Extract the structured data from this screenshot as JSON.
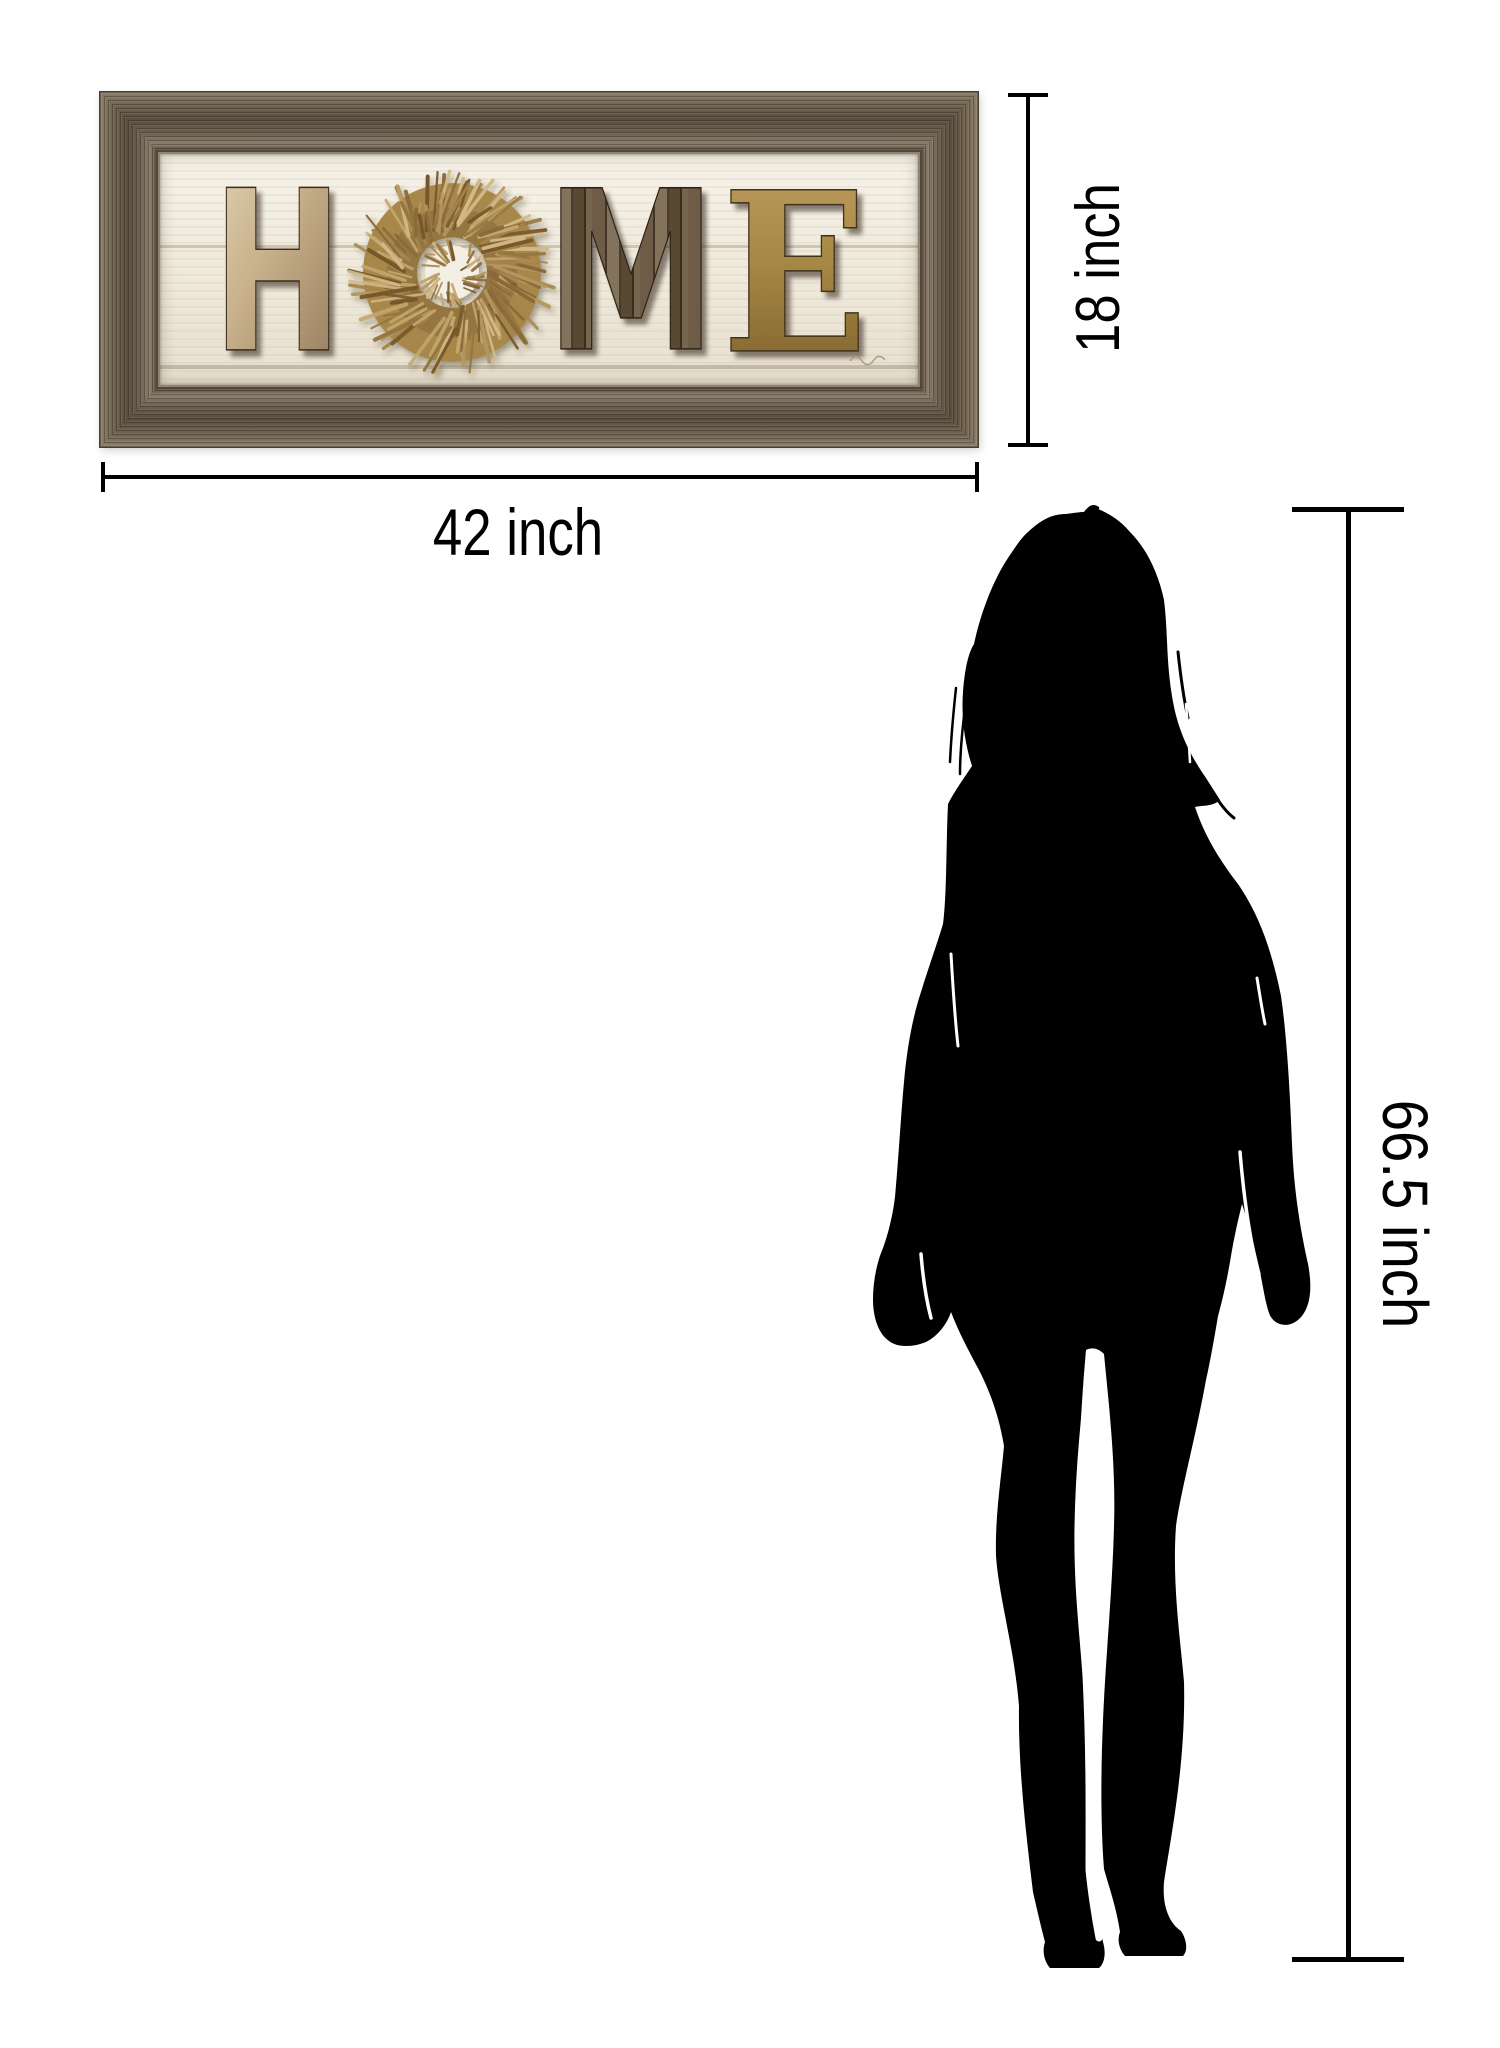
{
  "background_color": "#ffffff",
  "line_color": "#000000",
  "artwork": {
    "word": "HOME",
    "letters": {
      "h": "H",
      "m": "M",
      "e": "E"
    },
    "letter_o_style": "wheat wreath",
    "frame_color": "#6d6152",
    "panel_color": "#f2ecdf",
    "letter_h_color": "#c9b28d",
    "letter_m_color": "#5f4f3d",
    "letter_e_color": "#a78844",
    "wreath_color": "#a8874c"
  },
  "dimensions": {
    "width": {
      "label": "42 inch"
    },
    "height": {
      "label": "18 inch"
    },
    "person_height": {
      "label": "66.5 inch"
    }
  },
  "figure": {
    "type": "standing woman silhouette",
    "color": "#000000"
  }
}
